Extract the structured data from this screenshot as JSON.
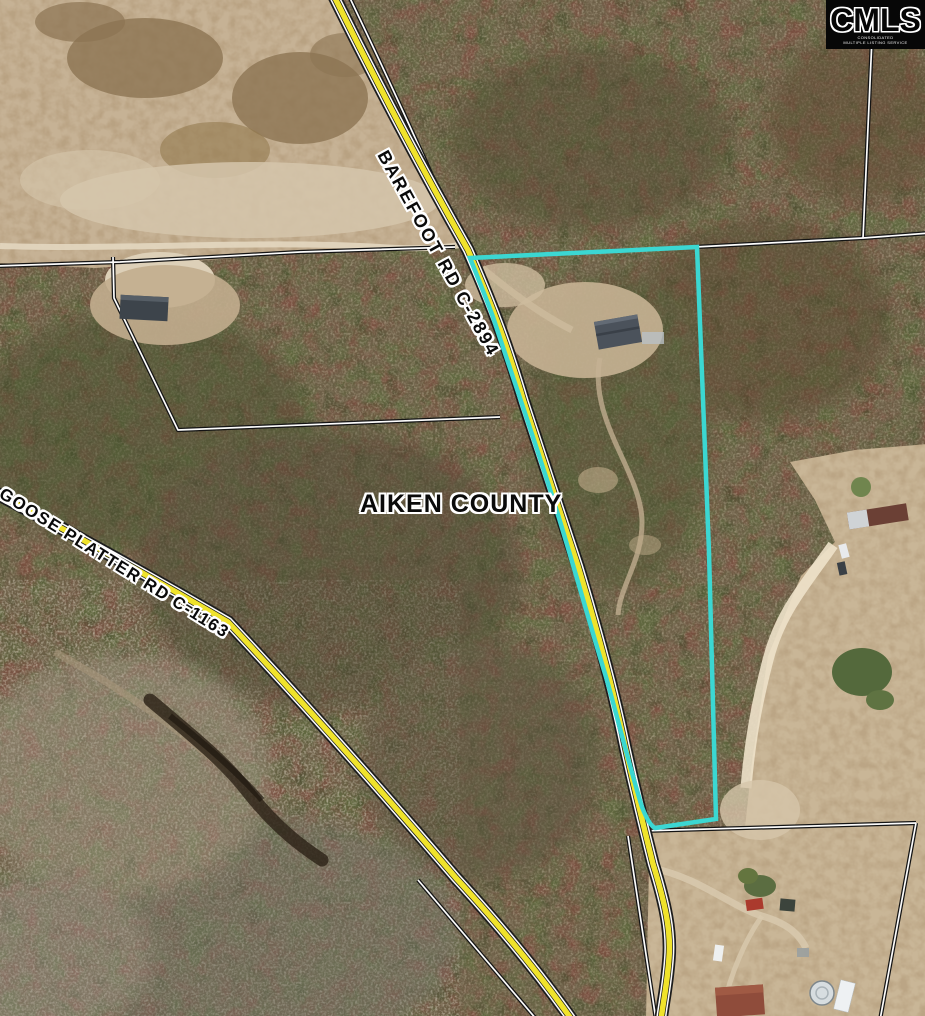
{
  "logo": {
    "title": "CMLS",
    "subtitle_line1": "CONSOLIDATED",
    "subtitle_line2": "MULTIPLE LISTING SERVICE"
  },
  "map": {
    "county_label": "AIKEN COUNTY",
    "roads": [
      {
        "name": "BAREFOOT RD C-2894"
      },
      {
        "name": "GOOSE PLATTER RD C-1163"
      }
    ],
    "colors": {
      "parcel_boundary": "#3bd7d2",
      "road_fill": "#f0e32b"
    }
  }
}
